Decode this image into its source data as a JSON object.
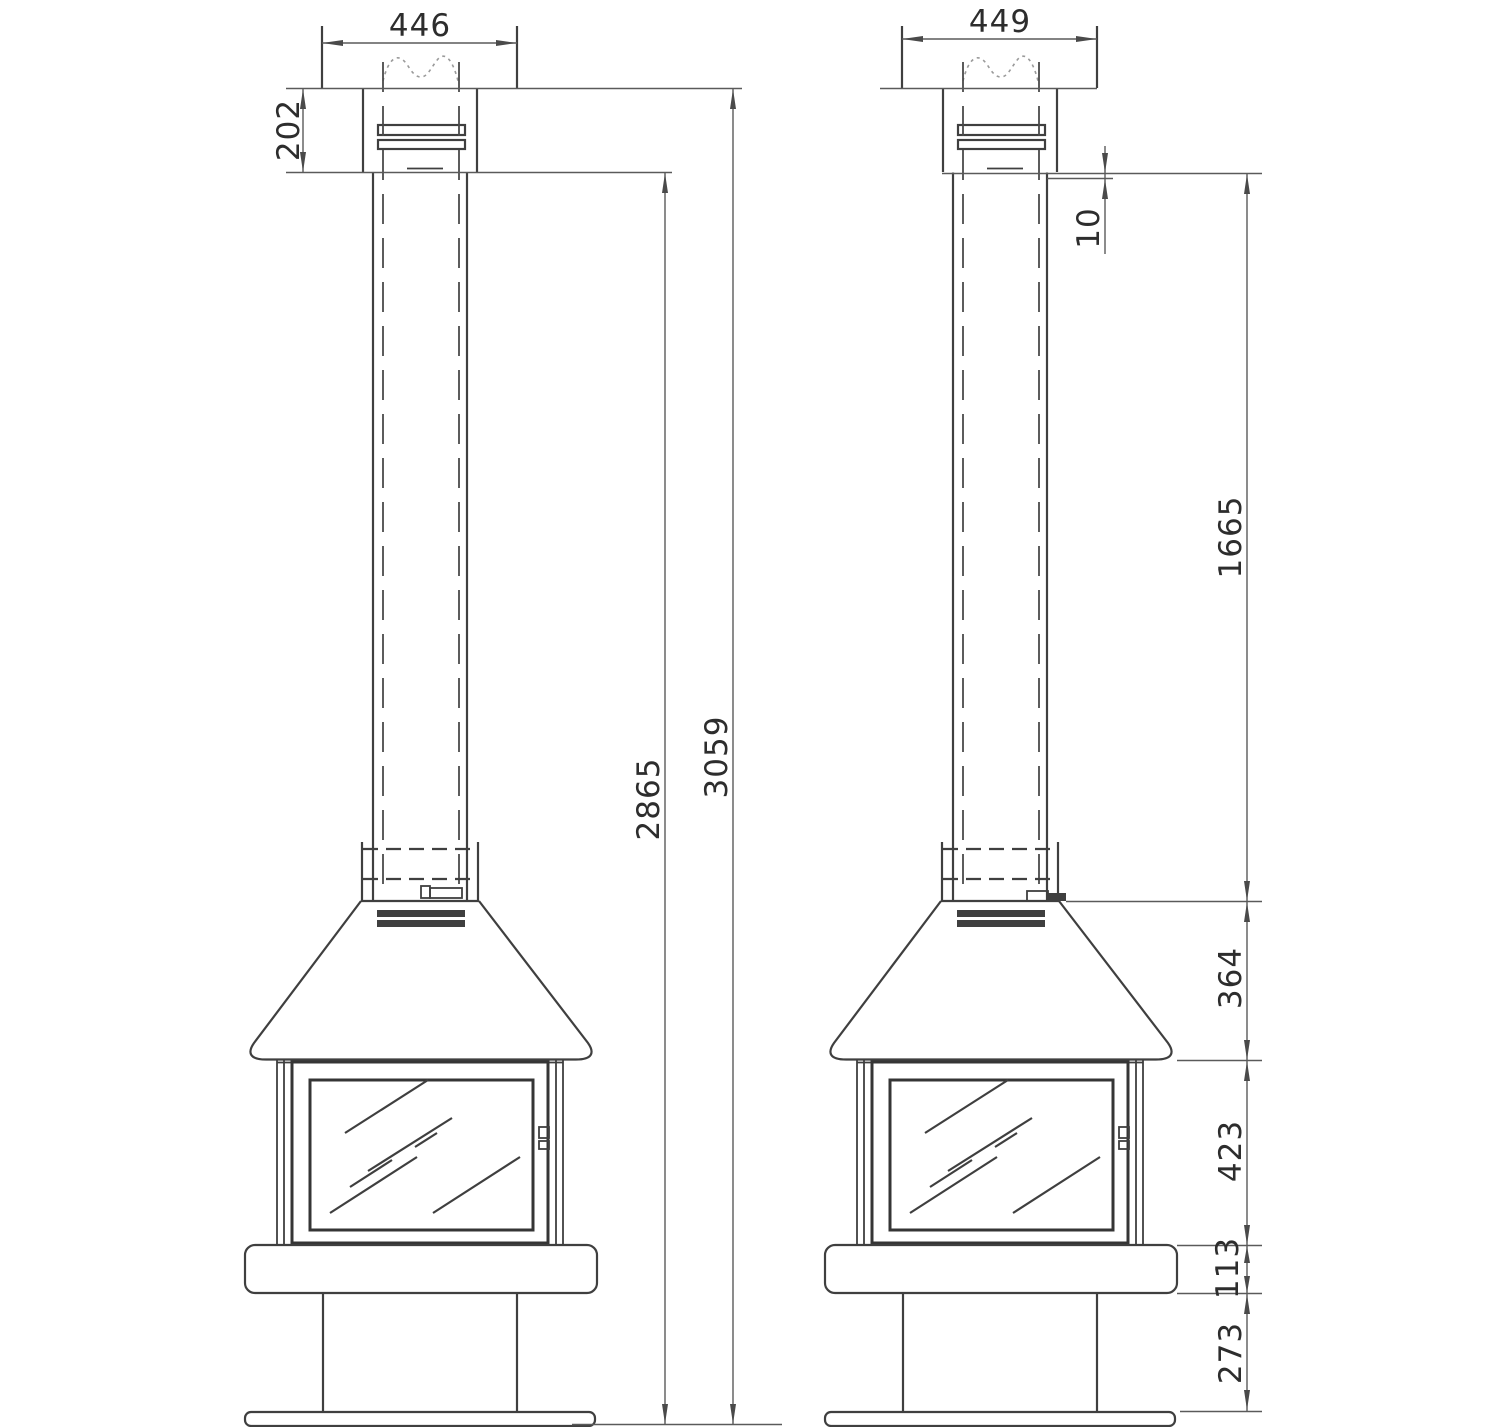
{
  "drawing": {
    "background": "#ffffff",
    "line_color": "#3f3f3f",
    "dim_line_color": "#5a5a5a",
    "text_color": "#2d2d2d",
    "views": {
      "front": {
        "dims": {
          "top_width": "446",
          "cap_height": "202",
          "body_height": "2865",
          "total_height": "3059"
        }
      },
      "side": {
        "dims": {
          "top_width": "449",
          "collar_gap": "10",
          "pipe_length": "1665",
          "hood_height": "364",
          "firebox_height": "423",
          "base_height": "113",
          "pedestal_height": "273"
        }
      }
    }
  }
}
